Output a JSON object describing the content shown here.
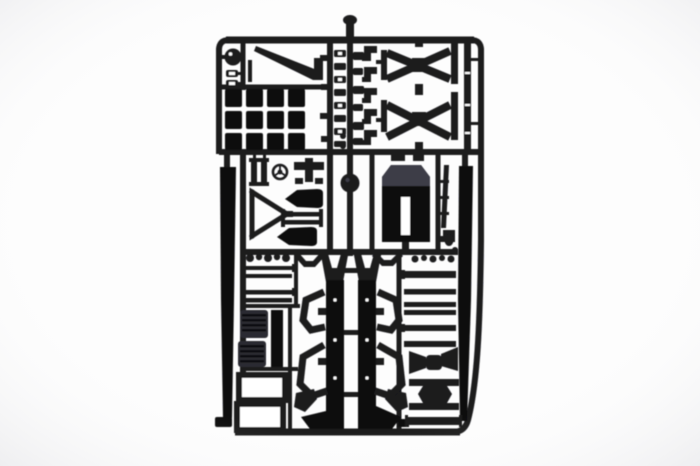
{
  "photo": {
    "subject": "model kit sprue product photo",
    "description": "Product photograph of a black injection-molded plastic model kit sprue (parts tree) with truck trailer chassis parts: window panels, cross braces, cab panel, side rails, twin chassis rails with suspension arms, grilles, frames and ladder bars, on a plain white background",
    "background_tone": "white",
    "plastic_tone": "black styrene"
  },
  "colors": {
    "background": "#fdfdfd",
    "vignette": "#dcdce2",
    "plastic": "#1a1a1f",
    "plastic-deep": "#0d0d11",
    "plastic-sheen": "#3e3e46",
    "grille-face": "#2b2b32",
    "white-gap": "#ffffff"
  }
}
